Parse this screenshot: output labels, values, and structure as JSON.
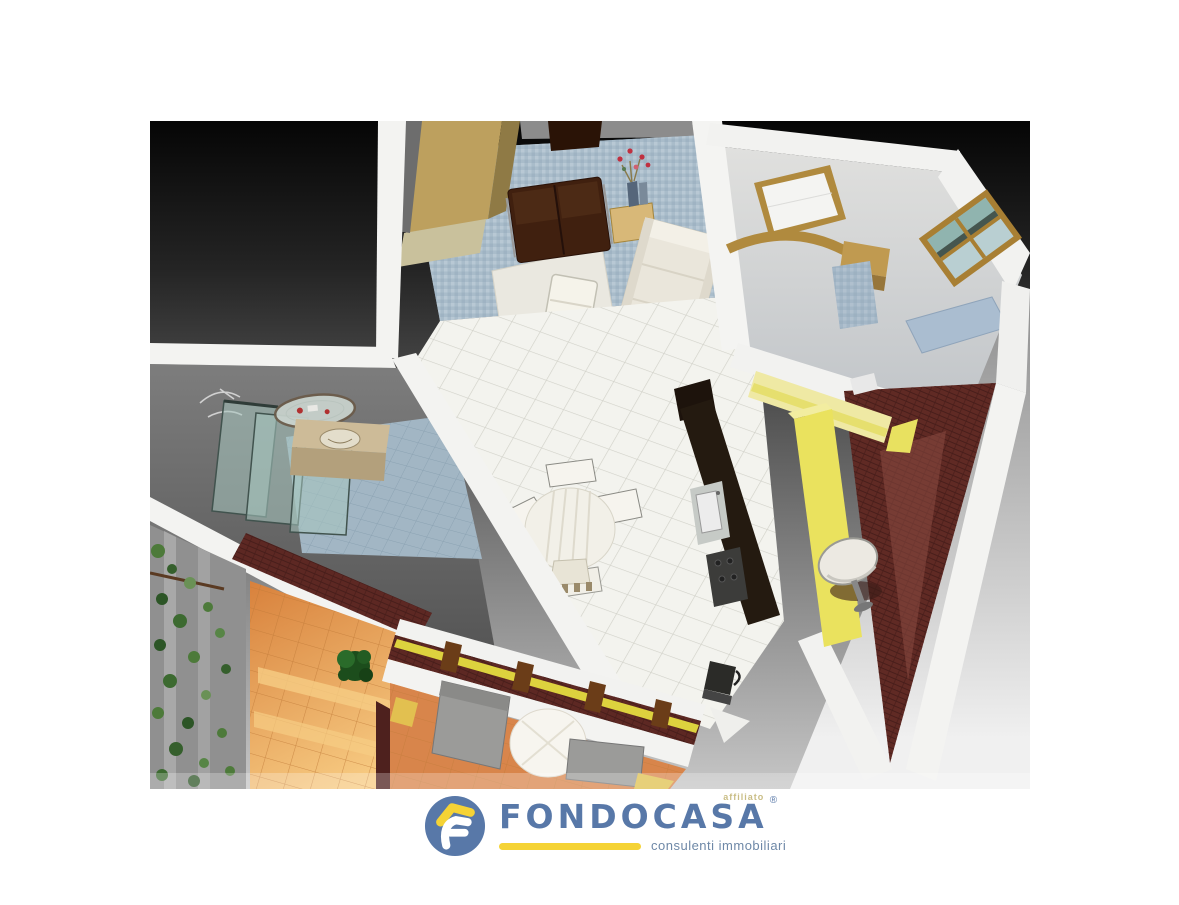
{
  "page": {
    "background_color": "#ffffff"
  },
  "artwork": {
    "type": "3d-isometric-floorplan-render",
    "backdrop_top_color": "#060606",
    "backdrop_bottom_color": "#d9d9d9",
    "palette": {
      "wall_white": "#f3f3f1",
      "wall_gray": "#8c8c8c",
      "accent_tan": "#bda05e",
      "mosaic_blue": "#a9bcca",
      "tile_white": "#f3f3ee",
      "brick_maroon": "#5d2823",
      "terrace_orange": "#e09a55",
      "wall_yellow": "#eae25e",
      "plant_green": "#4d7a3a",
      "glass_teal": "#a7c6c0",
      "furniture_brown": "#40200f",
      "sofa_cream": "#eae6db"
    },
    "regions": [
      "living-room",
      "bedroom",
      "dining-area",
      "kitchen",
      "bathroom",
      "southeast-balcony",
      "southwest-terrace",
      "lower-bedroom"
    ]
  },
  "logo": {
    "brand": "FONDOCASA",
    "affiliate_label": "affiliato",
    "registered_mark": "®",
    "tagline": "consulenti immobiliari",
    "brand_color": "#5878a8",
    "accent_color": "#f5d335",
    "tagline_color": "#6e88a7"
  }
}
